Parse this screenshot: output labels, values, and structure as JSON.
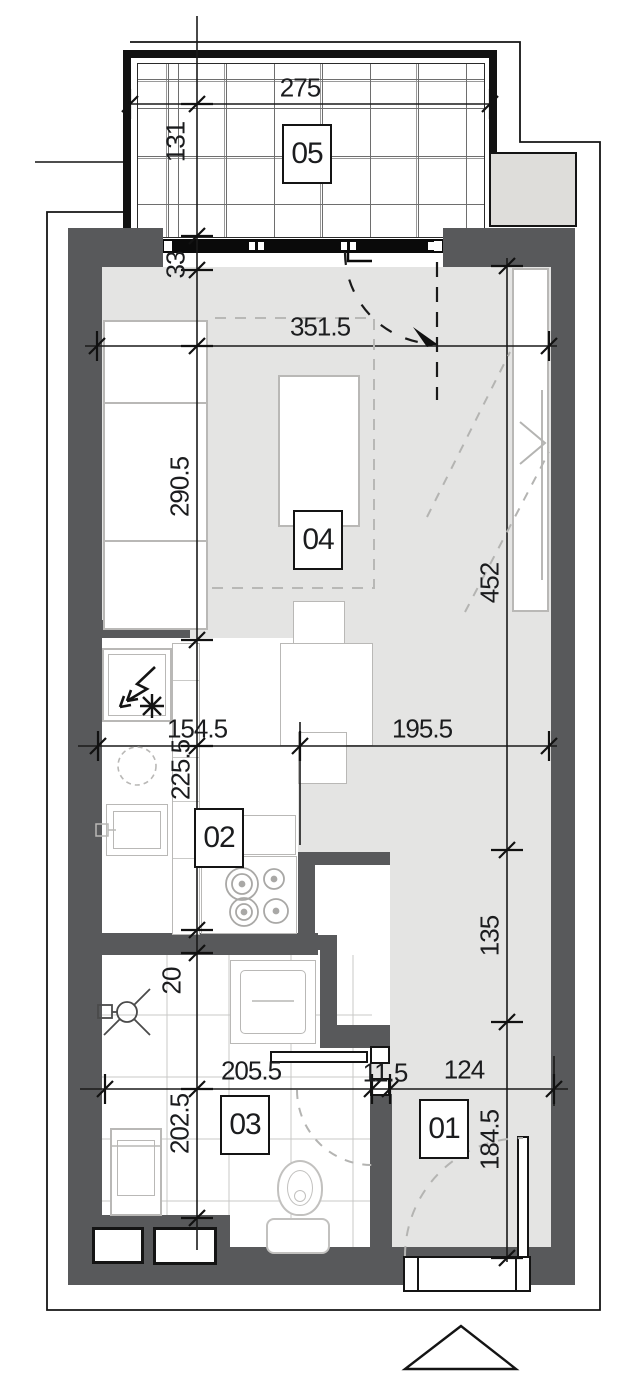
{
  "drawing": {
    "type": "apartment-floor-plan",
    "north_marker": "triangle-up"
  },
  "colors": {
    "wall": "#58595b",
    "floor": "#e4e4e3",
    "line_black": "#141414",
    "fixture_line": "#b9b8b6",
    "grout": "#c9c9c7",
    "neighbor_slab": "#deddda",
    "dash_gray": "#b4b4b2",
    "dim_text": "#1b1c1e"
  },
  "room_labels": [
    {
      "id": "05",
      "label": "05",
      "x": 307,
      "y": 154
    },
    {
      "id": "04",
      "label": "04",
      "x": 318,
      "y": 540
    },
    {
      "id": "02",
      "label": "02",
      "x": 219,
      "y": 838
    },
    {
      "id": "03",
      "label": "03",
      "x": 245,
      "y": 1125
    },
    {
      "id": "01",
      "label": "01",
      "x": 444,
      "y": 1129
    }
  ],
  "dimensions": [
    {
      "text": "275",
      "x": 300,
      "y": 88,
      "rot": 0
    },
    {
      "text": "131",
      "x": 176,
      "y": 142,
      "rot": -90
    },
    {
      "text": "33",
      "x": 176,
      "y": 265,
      "rot": -90
    },
    {
      "text": "351.5",
      "x": 320,
      "y": 327,
      "rot": 0
    },
    {
      "text": "290.5",
      "x": 180,
      "y": 487,
      "rot": -90
    },
    {
      "text": "452",
      "x": 490,
      "y": 583,
      "rot": -90
    },
    {
      "text": "154.5",
      "x": 197,
      "y": 729,
      "rot": 0
    },
    {
      "text": "195.5",
      "x": 422,
      "y": 729,
      "rot": 0
    },
    {
      "text": "225.5",
      "x": 181,
      "y": 770,
      "rot": -90
    },
    {
      "text": "135",
      "x": 490,
      "y": 936,
      "rot": -90
    },
    {
      "text": "20",
      "x": 172,
      "y": 981,
      "rot": -90
    },
    {
      "text": "202.5",
      "x": 180,
      "y": 1124,
      "rot": -90
    },
    {
      "text": "205.5",
      "x": 251,
      "y": 1071,
      "rot": 0
    },
    {
      "text": "11.5",
      "x": 385,
      "y": 1073,
      "rot": 0
    },
    {
      "text": "124",
      "x": 464,
      "y": 1070,
      "rot": 0
    },
    {
      "text": "184.5",
      "x": 490,
      "y": 1140,
      "rot": -90
    }
  ],
  "fixtures": [
    "balcony-tiles",
    "window-band",
    "fridge-icon",
    "snowflake-icon",
    "kitchen-sink",
    "cooktop-burners",
    "shower-icon",
    "washing-machine",
    "toilet",
    "washbasin",
    "bed",
    "dining-table",
    "desk",
    "chairs",
    "wardrobe",
    "entry-door",
    "door-swing-arcs",
    "shaft-boxes",
    "north-triangle-icon"
  ]
}
